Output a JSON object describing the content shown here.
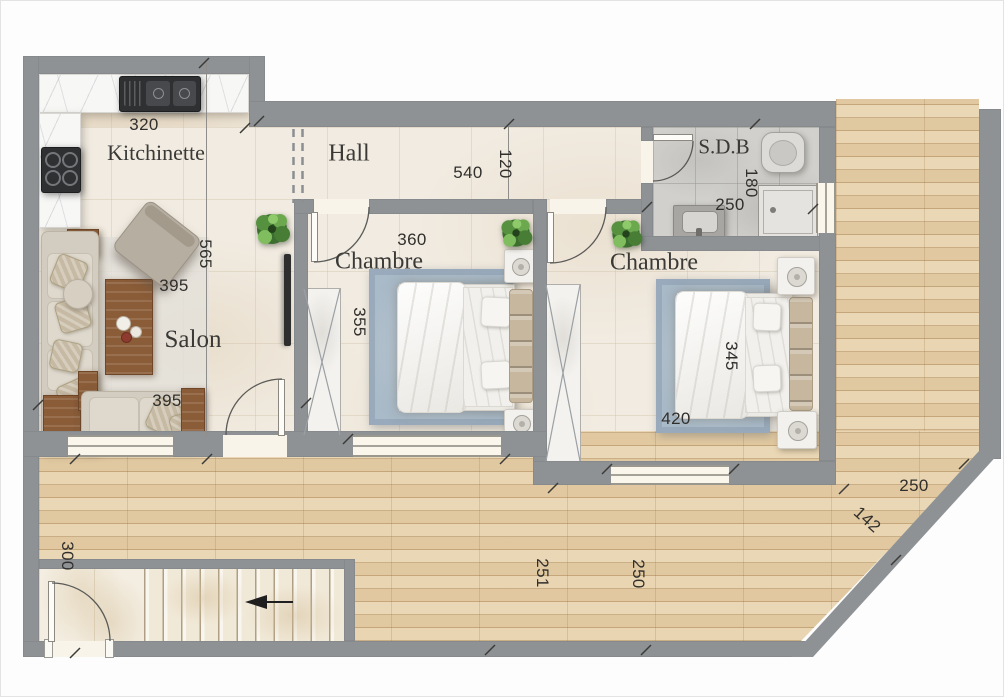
{
  "floorplan": {
    "rooms": [
      {
        "id": "kitchinette",
        "label": "Kitchinette"
      },
      {
        "id": "hall",
        "label": "Hall"
      },
      {
        "id": "salon",
        "label": "Salon"
      },
      {
        "id": "chambre-1",
        "label": "Chambre"
      },
      {
        "id": "chambre-2",
        "label": "Chambre"
      },
      {
        "id": "sdb",
        "label": "S.D.B"
      }
    ],
    "dimensions": [
      {
        "id": "kitchinette-width",
        "text": "320"
      },
      {
        "id": "hall-length",
        "text": "540"
      },
      {
        "id": "hall-width",
        "text": "120"
      },
      {
        "id": "sdb-width",
        "text": "250"
      },
      {
        "id": "sdb-depth",
        "text": "180"
      },
      {
        "id": "kitchinette-salon-depth",
        "text": "565"
      },
      {
        "id": "chambre1-width",
        "text": "360"
      },
      {
        "id": "chambre1-depth",
        "text": "355"
      },
      {
        "id": "salon-width-upper",
        "text": "395"
      },
      {
        "id": "salon-width-lower",
        "text": "395"
      },
      {
        "id": "chambre2-width",
        "text": "420"
      },
      {
        "id": "chambre2-depth",
        "text": "345"
      },
      {
        "id": "terrace-right-width",
        "text": "250"
      },
      {
        "id": "terrace-diagonal",
        "text": "142"
      },
      {
        "id": "entry-width",
        "text": "300"
      },
      {
        "id": "terrace-length-left",
        "text": "251"
      },
      {
        "id": "terrace-length-right",
        "text": "250"
      }
    ],
    "colors": {
      "wall": "#8e9295",
      "interior_floor": "#f1ebe1",
      "bath_floor": "#d1d0cc",
      "deck_wood": "#e6d0aa",
      "rug": "#a9bac8",
      "furniture_wood": "#8a5c38",
      "appliance_dark": "#2e3032",
      "plant_green": "#569140"
    }
  }
}
